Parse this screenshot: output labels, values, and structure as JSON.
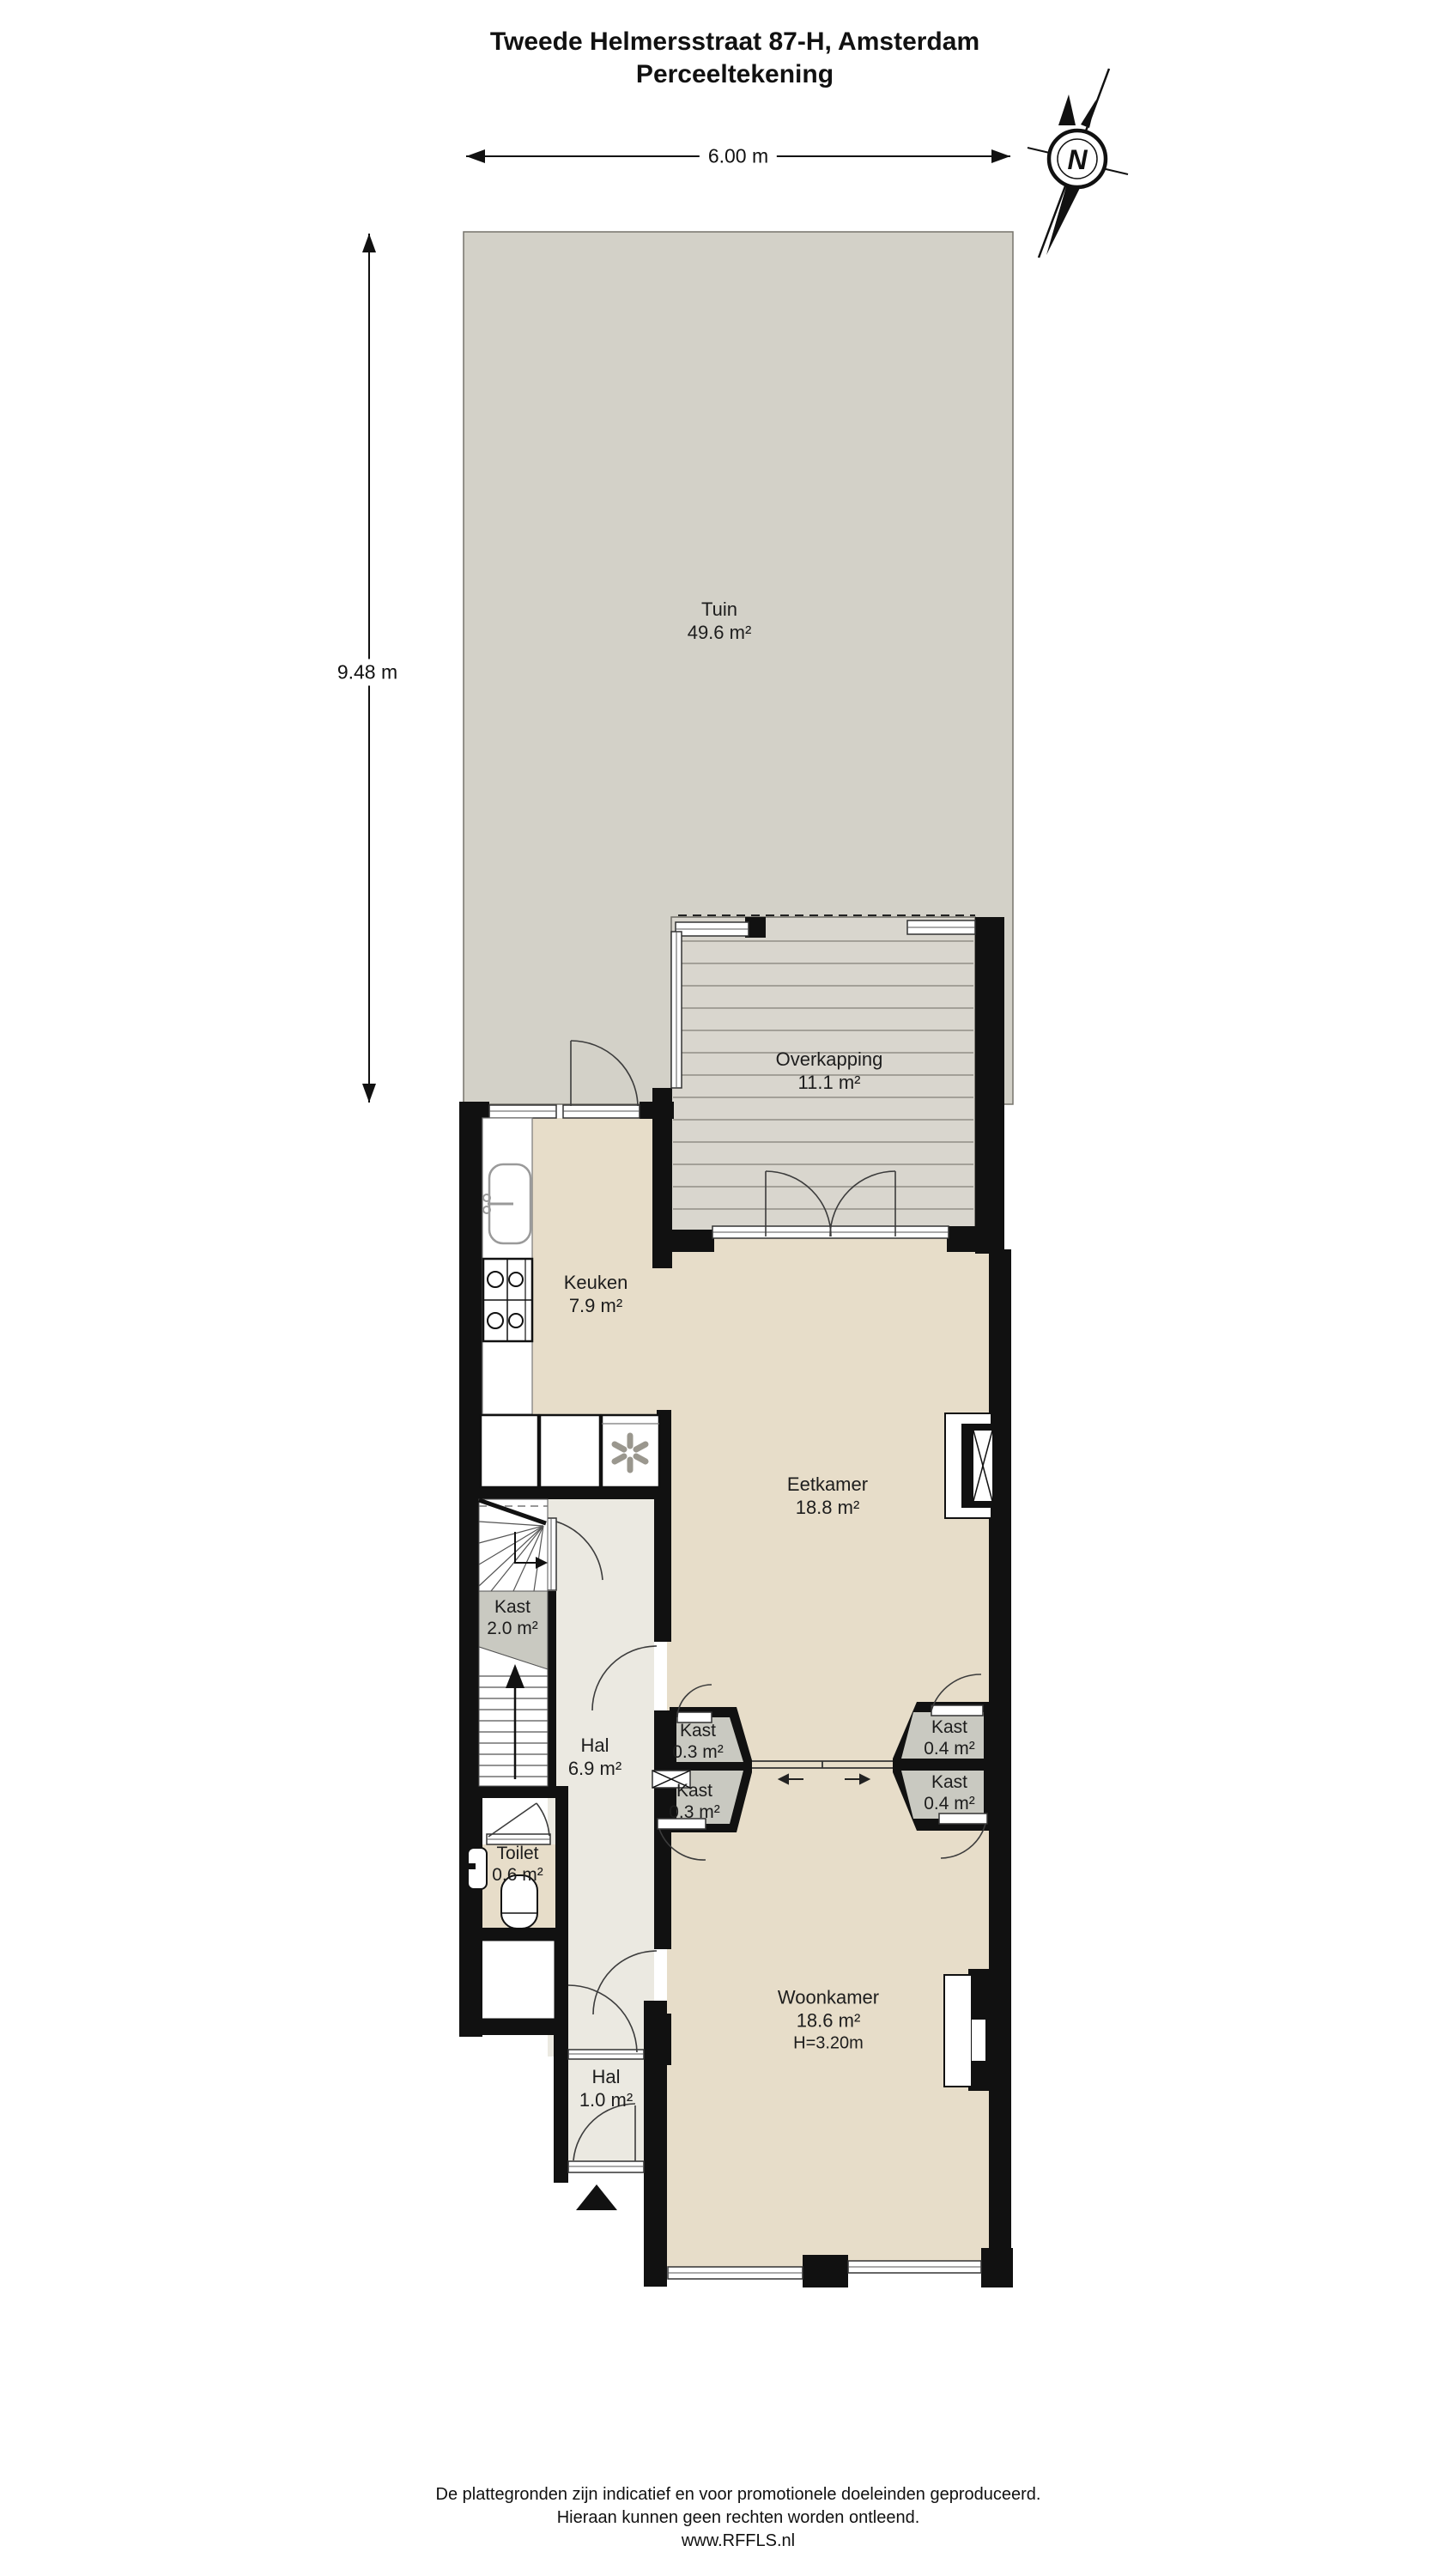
{
  "title": {
    "line1": "Tweede Helmersstraat 87-H, Amsterdam",
    "line2": "Perceeltekening"
  },
  "dimensions": {
    "plot_width": "6.00 m",
    "plot_depth": "9.48 m"
  },
  "compass": {
    "north": "N"
  },
  "rooms": {
    "tuin": {
      "name": "Tuin",
      "area": "49.6 m²"
    },
    "overkapping": {
      "name": "Overkapping",
      "area": "11.1 m²"
    },
    "keuken": {
      "name": "Keuken",
      "area": "7.9 m²"
    },
    "eetkamer": {
      "name": "Eetkamer",
      "area": "18.8 m²"
    },
    "kast_trap": {
      "name": "Kast",
      "area": "2.0 m²"
    },
    "hal": {
      "name": "Hal",
      "area": "6.9 m²"
    },
    "kast_links_1": {
      "name": "Kast",
      "area": "0.3 m²"
    },
    "kast_links_2": {
      "name": "Kast",
      "area": "0.3 m²"
    },
    "kast_rechts_1": {
      "name": "Kast",
      "area": "0.4 m²"
    },
    "kast_rechts_2": {
      "name": "Kast",
      "area": "0.4 m²"
    },
    "toilet": {
      "name": "Toilet",
      "area": "0.6 m²"
    },
    "woonkamer": {
      "name": "Woonkamer",
      "area": "18.6 m²",
      "ceiling_height": "H=3.20m"
    },
    "hal_entree": {
      "name": "Hal",
      "area": "1.0 m²"
    }
  },
  "footer": {
    "line1": "De plattegronden zijn indicatief en voor promotionele doeleinden geproduceerd.",
    "line2": "Hieraan kunnen geen rechten worden ontleend.",
    "line3": "www.RFFLS.nl"
  },
  "colors": {
    "wall": "#111111",
    "garden": "#d3d1c8",
    "deck": "#d9d6ce",
    "floor": "#e7ddc9",
    "hall_floor": "#ebe9e1",
    "closet": "#c9c9c1"
  }
}
